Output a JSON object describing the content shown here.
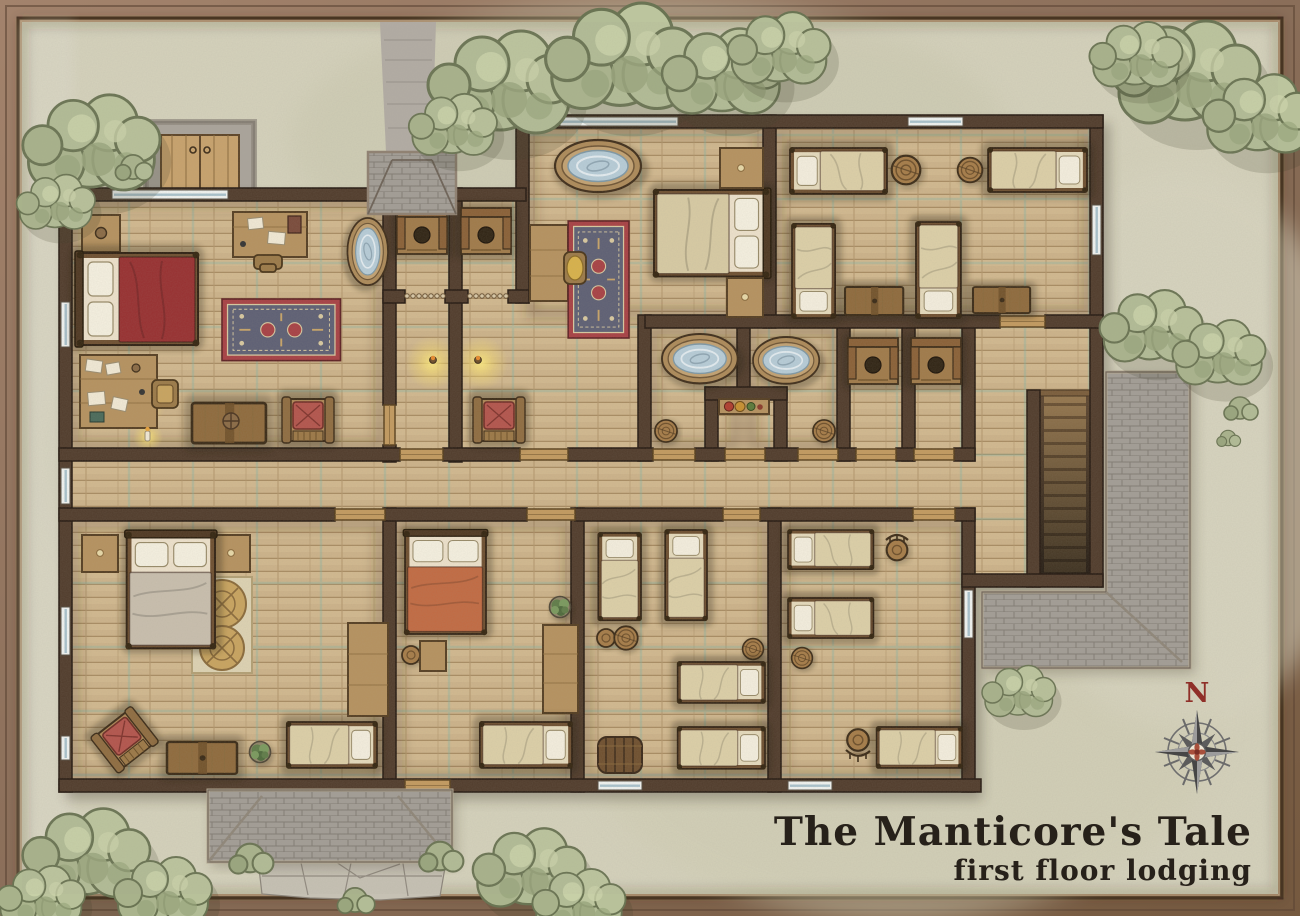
{
  "map": {
    "title": "The Manticore's Tale",
    "subtitle": "first floor lodging",
    "compass": {
      "north_label": "N"
    }
  },
  "palette": {
    "frame_wood": "#8f7460",
    "parchment": "#d6d3bd",
    "grass_patch": "#c9c7ad",
    "wall": "#503b2b",
    "floor_wood": "#cdb38a",
    "grid_line": "#7fb5a8",
    "roof_shingle": "#a29d96",
    "water": "#b7cdd9",
    "glow": "#ffe873",
    "bed_red": "#982f30",
    "bed_tan": "#d8cba4",
    "bed_grey": "#c9bfae",
    "bed_orange": "#c26a42",
    "rug_red": "#a84044",
    "cushion_red": "#b4544c",
    "tree_green": "#b2bc96",
    "compass_red": "#8f2f28"
  },
  "rooms": [
    {
      "id": "master-bedroom",
      "furniture": [
        "double-bed-red",
        "nightstand",
        "writing-desk",
        "desk-chair",
        "bathtub",
        "ornate-rug",
        "cluttered-desk",
        "candle",
        "tool-chest",
        "armchair"
      ]
    },
    {
      "id": "privy-1",
      "furniture": [
        "privy-seat",
        "beaded-curtain"
      ]
    },
    {
      "id": "privy-2",
      "furniture": [
        "privy-seat",
        "beaded-curtain"
      ]
    },
    {
      "id": "middle-bedroom",
      "furniture": [
        "bathtub",
        "side-table",
        "chair",
        "ornate-rug",
        "double-bed-tan",
        "nightstand",
        "nightstand"
      ]
    },
    {
      "id": "corridor",
      "furniture": [
        "wall-torch",
        "wall-torch",
        "armchair"
      ]
    },
    {
      "id": "northeast-dormitory",
      "furniture": [
        "single-bed",
        "single-bed",
        "single-bed",
        "single-bed",
        "barrel",
        "barrel",
        "storage-chest",
        "storage-chest"
      ]
    },
    {
      "id": "bath-1",
      "furniture": [
        "bathtub",
        "stool"
      ]
    },
    {
      "id": "bath-2",
      "furniture": [
        "bathtub",
        "stool"
      ]
    },
    {
      "id": "linen-niche",
      "furniture": [
        "shelf",
        "soap-jars"
      ]
    },
    {
      "id": "privy-3",
      "furniture": [
        "privy-seat"
      ]
    },
    {
      "id": "privy-4",
      "furniture": [
        "privy-seat"
      ]
    },
    {
      "id": "stair-hall",
      "furniture": [
        "staircase-down"
      ]
    },
    {
      "id": "hallway",
      "furniture": []
    },
    {
      "id": "southwest-bedroom",
      "furniture": [
        "double-bed-grey",
        "nightstand",
        "nightstand",
        "round-rug",
        "armchair",
        "tool-chest",
        "potted-plant",
        "single-bed",
        "long-table"
      ]
    },
    {
      "id": "south-bedroom",
      "furniture": [
        "double-bed-orange",
        "stool",
        "side-table",
        "potted-plant",
        "long-table",
        "single-bed"
      ]
    },
    {
      "id": "south-dormitory",
      "furniture": [
        "single-bed",
        "single-bed",
        "single-bed",
        "single-bed",
        "stool",
        "barrel",
        "cask"
      ]
    },
    {
      "id": "southeast-dormitory",
      "furniture": [
        "single-bed",
        "single-bed",
        "single-bed",
        "stool",
        "stool",
        "barrel"
      ]
    }
  ],
  "exterior": {
    "features": [
      "tree-clusters",
      "stone-cellar-doors",
      "gravel-path",
      "shingled-porch-roof",
      "flagstone-path",
      "bushes",
      "side-roof",
      "compass-rose"
    ]
  }
}
